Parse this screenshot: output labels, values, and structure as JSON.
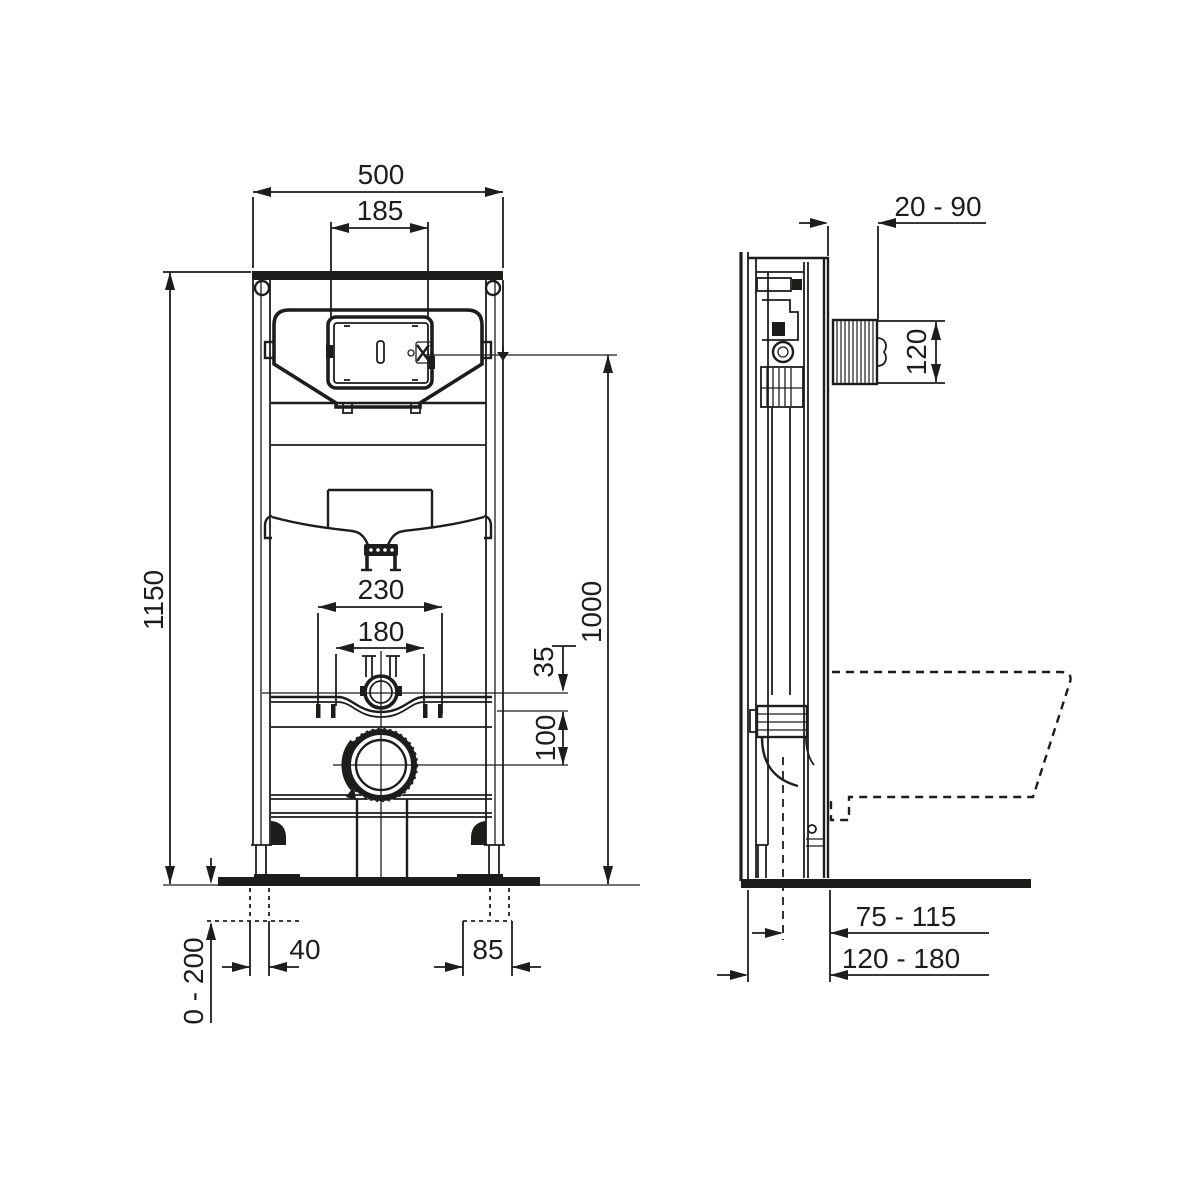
{
  "drawing": {
    "line_color": "#1d1d1b",
    "background_color": "#ffffff",
    "views": [
      "front-view",
      "side-view"
    ],
    "dims": {
      "front_width": "500",
      "plate_width": "185",
      "frame_height": "1150",
      "flush_height": "1000",
      "fixing_outer": "230",
      "fixing_inner": "180",
      "inlet_offset": "35",
      "drain_offset": "100",
      "foot_offset": "40",
      "foot_plate": "85",
      "leg_adjust": "0 - 200",
      "panel_gap": "20 - 90",
      "sleeve_height": "120",
      "drain_wall": "75 - 115",
      "frame_depth": "120 - 180"
    }
  }
}
